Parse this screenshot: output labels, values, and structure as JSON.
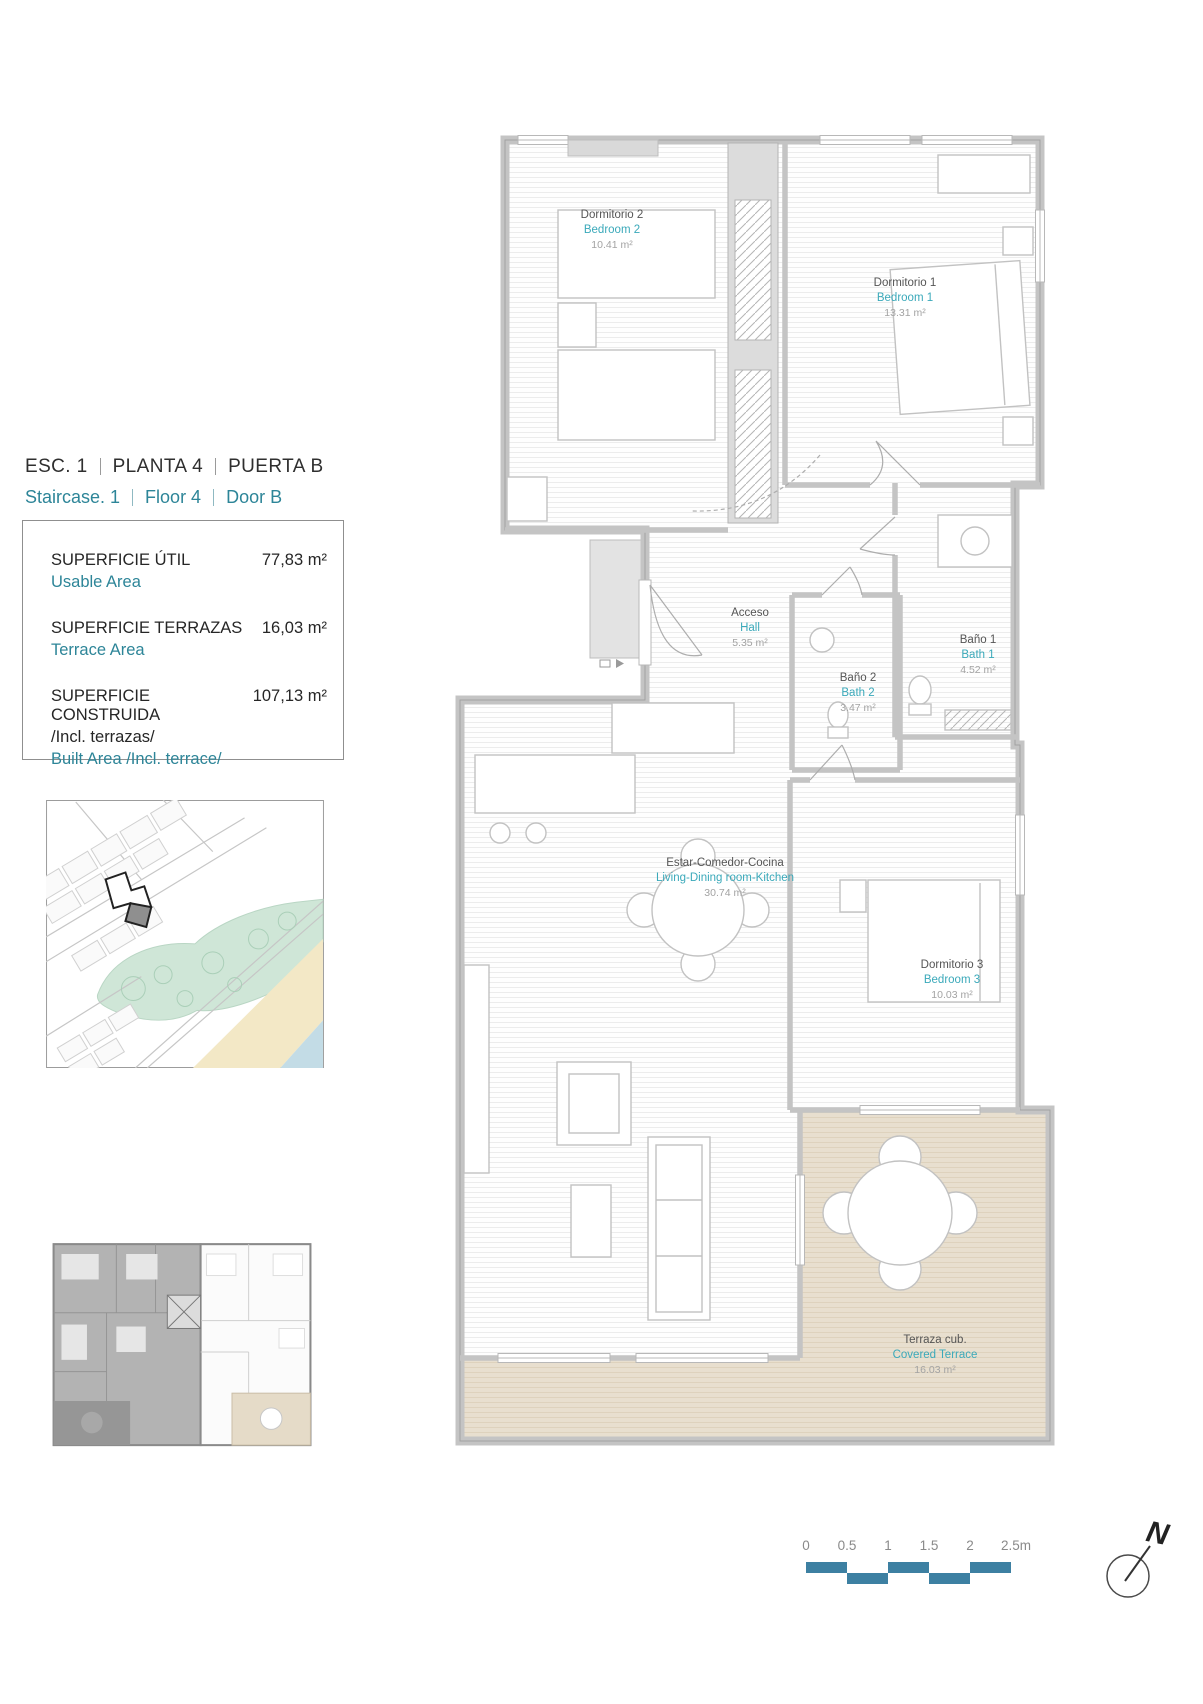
{
  "header": {
    "es": [
      "ESC. 1",
      "PLANTA 4",
      "PUERTA B"
    ],
    "en": [
      "Staircase. 1",
      "Floor 4",
      "Door B"
    ]
  },
  "areas": {
    "rows": [
      {
        "label_es": "SUPERFICIE ÚTIL",
        "label_en": "Usable Area",
        "value": "77,83 m²"
      },
      {
        "label_es": "SUPERFICIE TERRAZAS",
        "label_en": "Terrace Area",
        "value": "16,03 m²"
      },
      {
        "label_es": "SUPERFICIE CONSTRUIDA",
        "note_es": "/Incl. terrazas/",
        "label_en": "Built Area /Incl. terrace/",
        "value": "107,13 m²"
      }
    ]
  },
  "plan": {
    "rooms": [
      {
        "name_es": "Dormitorio 2",
        "name_en": "Bedroom 2",
        "area": "10.41 m²"
      },
      {
        "name_es": "Dormitorio 1",
        "name_en": "Bedroom 1",
        "area": "13.31 m²"
      },
      {
        "name_es": "Acceso",
        "name_en": "Hall",
        "area": "5.35 m²"
      },
      {
        "name_es": "Baño 1",
        "name_en": "Bath 1",
        "area": "4.52 m²"
      },
      {
        "name_es": "Baño 2",
        "name_en": "Bath 2",
        "area": "3.47 m²"
      },
      {
        "name_es": "Estar-Comedor-Cocina",
        "name_en": "Living-Dining room-Kitchen",
        "area": "30.74 m²"
      },
      {
        "name_es": "Dormitorio 3",
        "name_en": "Bedroom 3",
        "area": "10.03 m²"
      },
      {
        "name_es": "Terraza cub.",
        "name_en": "Covered Terrace",
        "area": "16.03 m²"
      }
    ]
  },
  "scalebar": {
    "labels": [
      "0",
      "0.5",
      "1",
      "1.5",
      "2",
      "2.5m"
    ]
  },
  "north": {
    "label": "N"
  },
  "colors": {
    "teal_text": "#2d8598",
    "teal_room_label": "#3aa9ba",
    "scalebar_teal": "#3d80a2",
    "wall_gray": "#c6c6c6",
    "terrace_fill": "#e8dfcf",
    "map_park_green": "#cfe6d7",
    "map_beach_sand": "#f3e8c6",
    "map_sea_blue": "#c3dce6",
    "keyplan_gray": "#b3b3b3"
  }
}
